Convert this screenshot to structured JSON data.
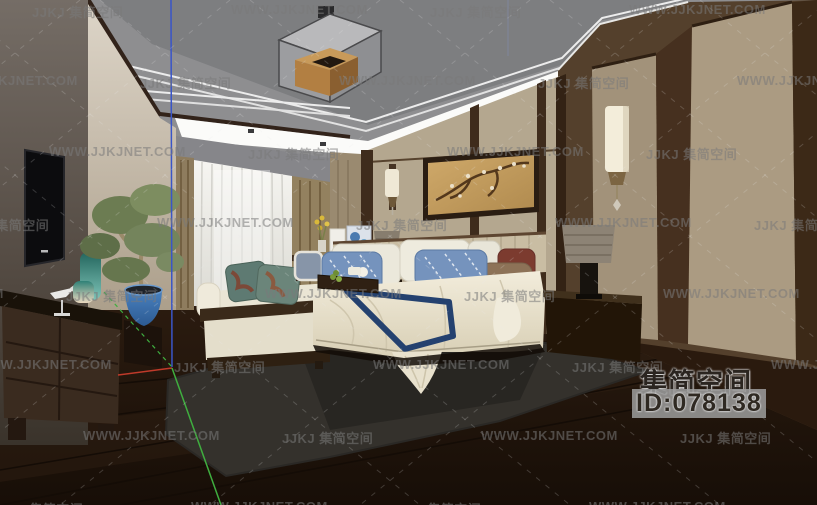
{
  "watermark": {
    "logo_text": "JJKJ 集简空间",
    "site_text": "WWW.JJKJNET.COM"
  },
  "brand_badge": {
    "name": "集简空间",
    "id": "ID:078138"
  },
  "palette": {
    "ceiling_gray": "#8e8e90",
    "ceiling_tray": "#7d7e80",
    "cove_white": "#fbfbf9",
    "wall_beige": "#b4a78f",
    "panel_linen": "#ab9b82",
    "wood_dark": "#3a2a1c",
    "floor_dark": "#20150d",
    "rug_gray": "#34312c",
    "curtain_white": "#f2f1ed",
    "duvet_cream": "#ece5d2",
    "runner_navy": "#24416f",
    "pillow_blue": "#7593bd",
    "pot_blue": "#3a72b4",
    "axis_red": "#c03a2a",
    "axis_green": "#3fae3f",
    "axis_blue": "#3a55c8"
  }
}
